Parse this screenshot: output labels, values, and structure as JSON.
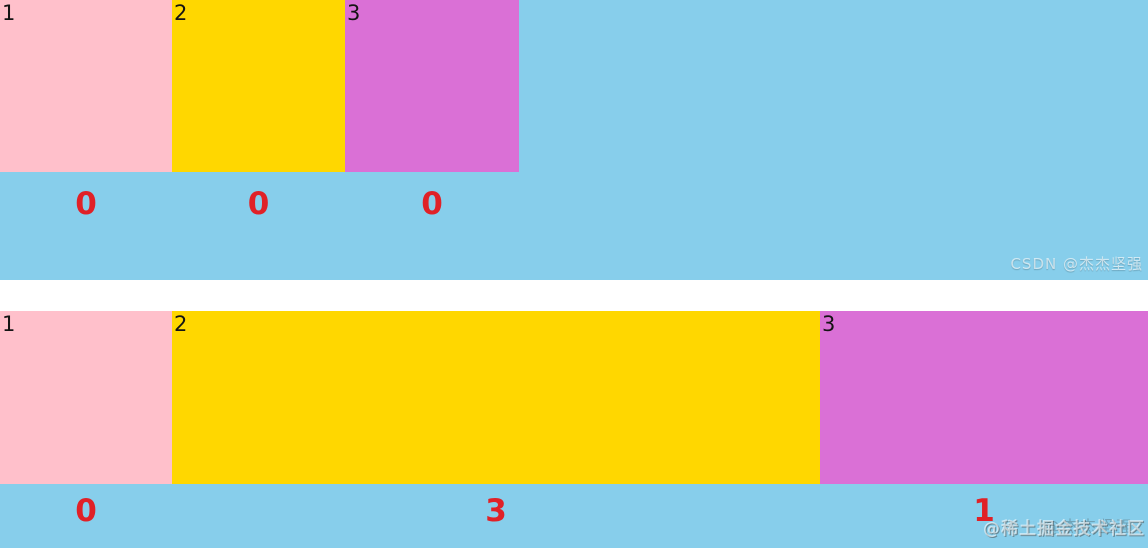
{
  "colors": {
    "page_bg": "#FFFFFF",
    "container_bg": "#87CEEB",
    "box1_bg": "#FFC0CB",
    "box2_bg": "#FFD700",
    "box3_bg": "#DA70D6",
    "box_label": "#141414",
    "grow_number": "#E02127"
  },
  "demo_top": {
    "items": [
      {
        "label": "1",
        "grow": "0"
      },
      {
        "label": "2",
        "grow": "0"
      },
      {
        "label": "3",
        "grow": "0"
      }
    ],
    "watermark": "CSDN @杰杰坚强"
  },
  "demo_bottom": {
    "items": [
      {
        "label": "1",
        "grow": "0"
      },
      {
        "label": "2",
        "grow": "3"
      },
      {
        "label": "3",
        "grow": "1"
      }
    ],
    "watermark_front": "@稀土掘金技术社区",
    "watermark_back": "@杰杰坚强"
  }
}
